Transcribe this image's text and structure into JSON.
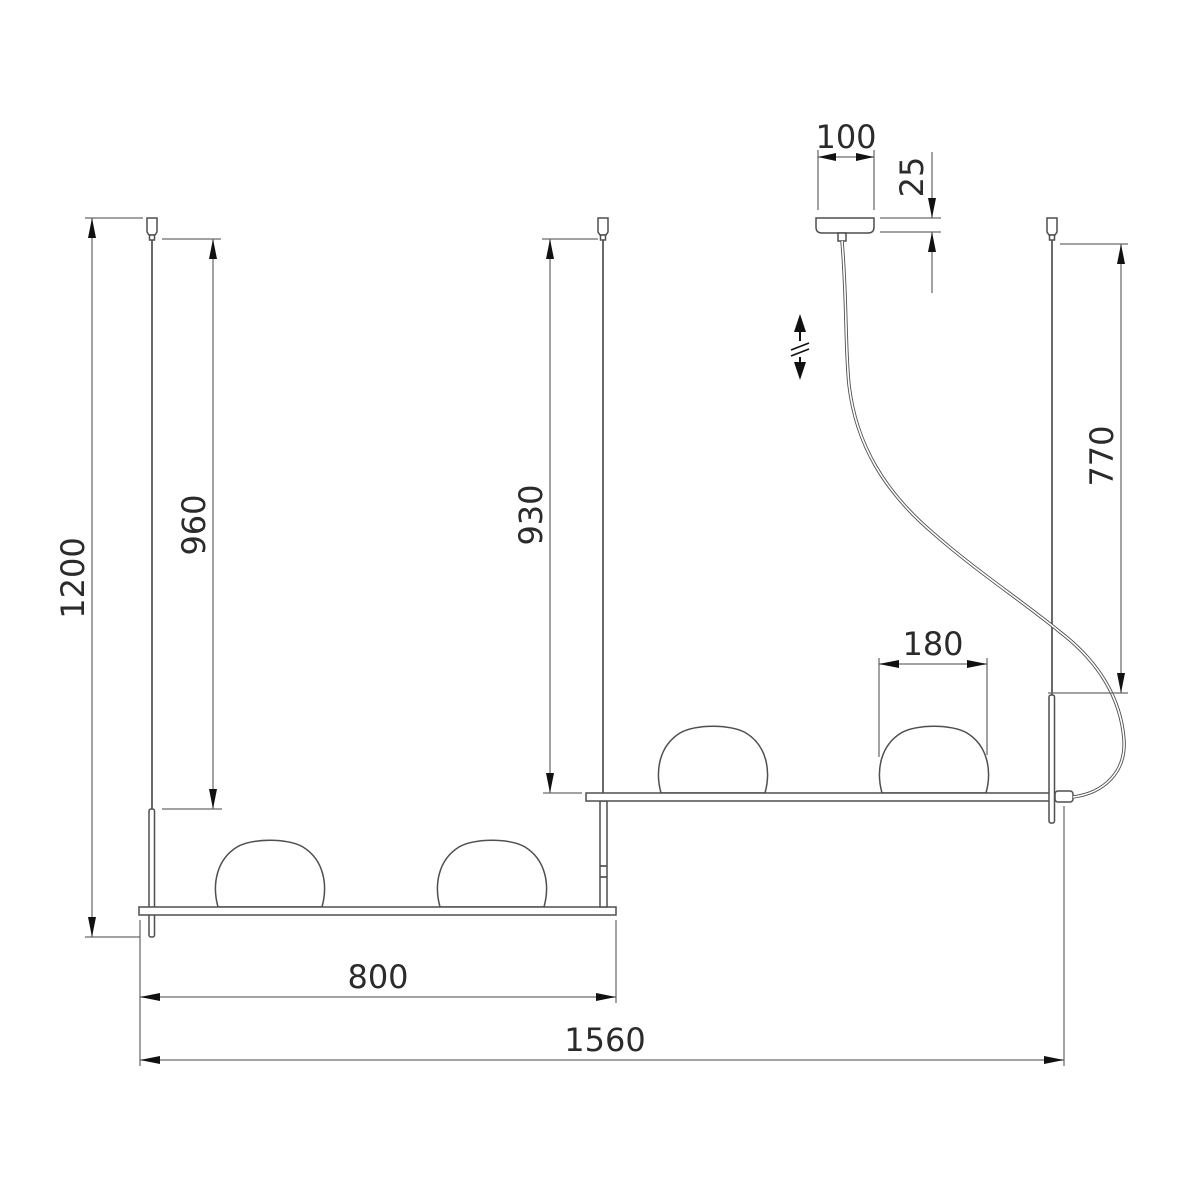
{
  "drawing": {
    "type": "technical-dimension-drawing",
    "dimensions": {
      "overall_height": "1200",
      "left_suspension_drop": "960",
      "middle_suspension_drop": "930",
      "cable_suspension_drop": "770",
      "canopy_width": "100",
      "canopy_height": "25",
      "shade_width": "180",
      "lower_bar_length": "800",
      "overall_width": "1560"
    },
    "symbols": {
      "adjustable_height": "double-arrow-with-break"
    },
    "colors": {
      "line": "#4f4f4f",
      "dim_line": "#6a6a6a",
      "arrow": "#111111",
      "text": "#2b2b2b",
      "background": "#ffffff"
    }
  }
}
